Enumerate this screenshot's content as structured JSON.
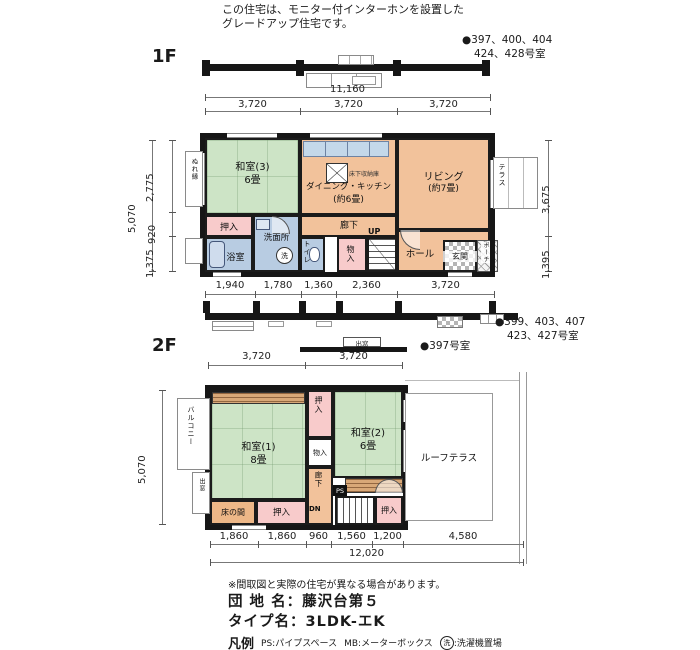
{
  "header": {
    "note1": "この住宅は、モニター付インターホンを設置した",
    "note2": "グレードアップ住宅です。",
    "units_top1": "●397、400、404",
    "units_top2": "424、428号室"
  },
  "f1": {
    "floor_label": "1F",
    "dim_total": "11,160",
    "dims_top": [
      "3,720",
      "3,720",
      "3,720"
    ],
    "dims_bottom": [
      "1,940",
      "1,780",
      "1,360",
      "2,360",
      "3,720"
    ],
    "dim_left_total": "5,070",
    "dims_left": [
      "2,775",
      "920",
      "1,375"
    ],
    "dims_right": [
      "3,675",
      "1,395"
    ],
    "washitsu3_name": "和室(3)",
    "washitsu3_size": "6畳",
    "dk_name": "ダイニング・キッチン",
    "dk_size": "(約6畳)",
    "living_name": "リビング",
    "living_size": "(約7畳)",
    "underfloor_label": "床下収納庫",
    "oshiire": "押入",
    "bath": "浴室",
    "washroom": "洗面所",
    "washer_symbol": "洗",
    "toilet": "トイレ",
    "storage": "物入",
    "corridor": "廊下",
    "up": "UP",
    "hall": "ホール",
    "entrance": "玄関",
    "porch": "ポーチ",
    "nureen": "ぬれ縁",
    "terrace": "テラス",
    "units_bottom1": "●399、403、407",
    "units_bottom2": "423、427号室"
  },
  "mid": {
    "demado": "出窓",
    "unit_397": "●397号室"
  },
  "f2": {
    "floor_label": "2F",
    "dims_top": [
      "3,720",
      "3,720"
    ],
    "dim_left_total": "5,070",
    "dims_bottom": [
      "1,860",
      "1,860",
      "960",
      "1,560",
      "1,200",
      "4,580"
    ],
    "dim_total": "12,020",
    "washitsu1_name": "和室(1)",
    "washitsu1_size": "8畳",
    "washitsu2_name": "和室(2)",
    "washitsu2_size": "6畳",
    "oshiire": "押入",
    "storage": "物入",
    "corridor": "廊下",
    "dn": "DN",
    "ps": "PS",
    "tokonoma": "床の間",
    "demado": "出窓",
    "balcony": "バルコニー",
    "roof_terrace": "ルーフテラス"
  },
  "footer": {
    "disclaimer": "※間取図と実際の住宅が異なる場合があります。",
    "estate_name": "団 地 名：藤沢台第５",
    "type_name": "タイプ名：3LDK-エK",
    "legend_label": "凡例",
    "legend_ps": "PS:パイプスペース",
    "legend_mb": "MB:メーターボックス",
    "legend_washer_symbol": "洗",
    "legend_washer": ":洗濯機置場"
  },
  "colors": {
    "tatami_green": "#cde4c6",
    "wood_orange": "#f2c29b",
    "closet_pink": "#f8cbcb",
    "water_blue": "#b8cce2",
    "wall_black": "#161616"
  }
}
